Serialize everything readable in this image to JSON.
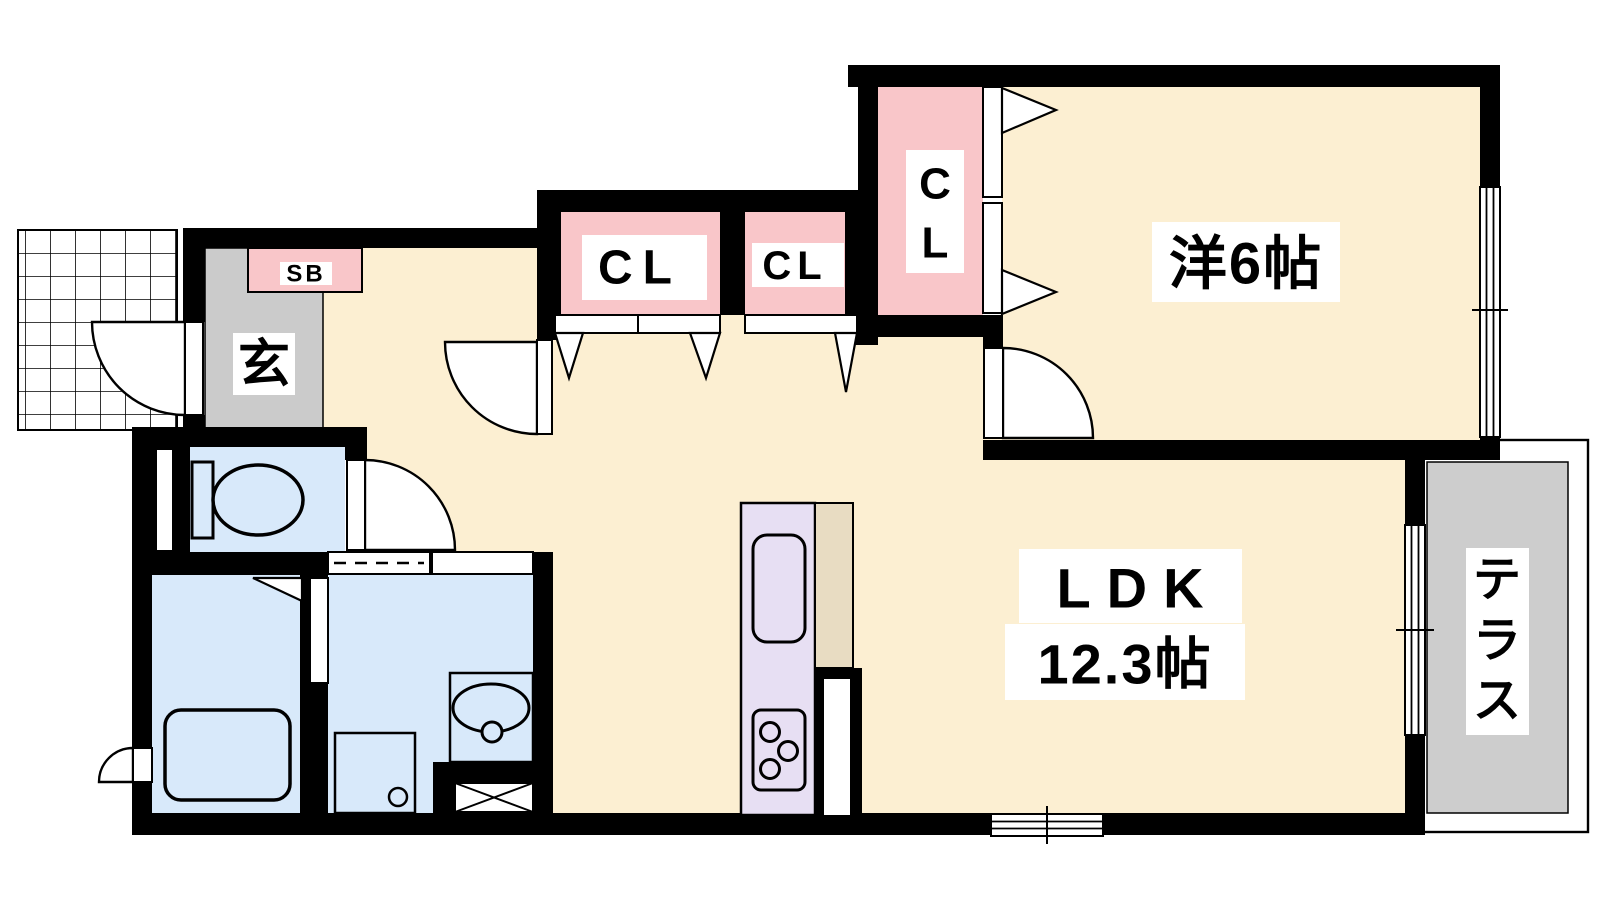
{
  "floorplan": {
    "rooms": {
      "western_room": {
        "label": "洋6帖"
      },
      "ldk": {
        "line1": "LDK",
        "line2": "12.3帖"
      },
      "entrance": {
        "label": "玄"
      },
      "shoe_box": {
        "label": "SB"
      },
      "terrace": {
        "label": "テラス",
        "label_chars": [
          "テ",
          "ラ",
          "ス"
        ]
      },
      "closet_hall_large": {
        "label": "CL"
      },
      "closet_hall_small": {
        "label": "CL"
      },
      "closet_bedroom": {
        "label": "CL",
        "label_chars": [
          "C",
          "L"
        ]
      }
    },
    "colors": {
      "floor": "#FCEFD2",
      "closet": "#F9C6C9",
      "wet_area": "#D8E9FA",
      "entrance_floor": "#CBCBCB",
      "terrace_floor": "#CDCDCD",
      "kitchen_counter": "#E7DFF3",
      "counter_top": "#E8DCC2",
      "wall": "#000000"
    }
  }
}
